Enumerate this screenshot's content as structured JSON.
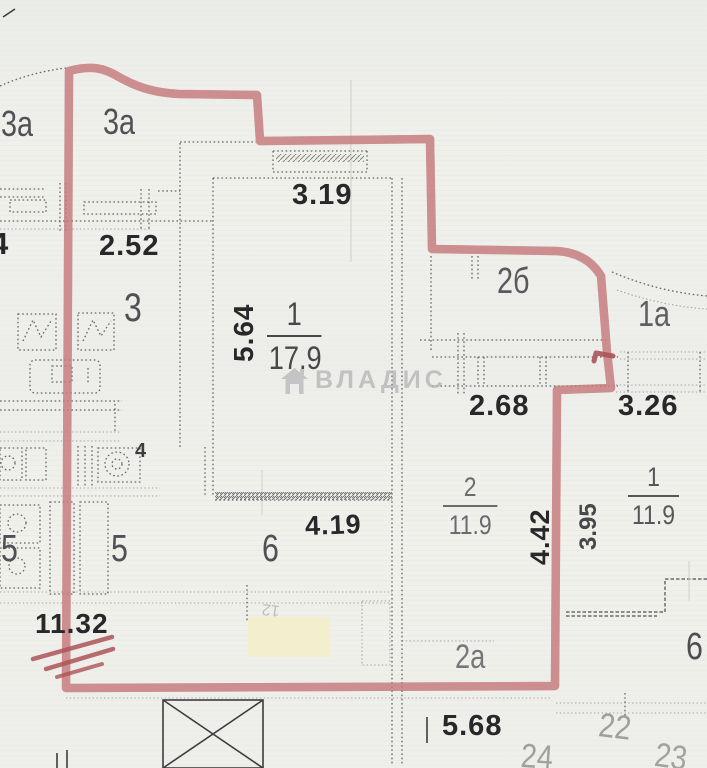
{
  "meta": {
    "kind": "scanned floor plan with red boundary marking"
  },
  "colors": {
    "outline_red": "#ab5357",
    "outline_red_soft": "#c4797c",
    "paper": "#f0f0eb",
    "ink_dark": "#28282a",
    "ink_gray": "#515155",
    "ink_faint": "#9e9e9c",
    "watermark_gray": "#b5b5b8",
    "highlight_yellow": "#f3eec8"
  },
  "watermark": {
    "text": "ВЛАДИС",
    "icon": "house-icon"
  },
  "rooms": {
    "balcony_3a_left": "3а",
    "balcony_3a_right": "3а",
    "room_3": "3",
    "room_4": "4",
    "room_5_left": "5",
    "room_5_right": "5",
    "room_6": "6",
    "room_6_right_edge": "6",
    "room_2b": "2б",
    "room_1a": "1а",
    "room_2a": "2а",
    "room_1_number": "1",
    "room_1_area": "17.9",
    "room_2_number": "2",
    "room_2_area": "11.9",
    "room_1_right_number": "1",
    "room_1_right_area": "11.9",
    "unit_22": "22",
    "unit_23": "23",
    "unit_24": "24",
    "bleedthrough_mark": "12"
  },
  "dimensions": {
    "d_252": "2.52",
    "d_319": "3.19",
    "d_564": "5.64",
    "d_268": "2.68",
    "d_326": "3.26",
    "d_419": "4.19",
    "d_442": "4.42",
    "d_395": "3.95",
    "d_1132": "11.32",
    "d_568": "5.68",
    "d_edge_fragment": "4"
  }
}
